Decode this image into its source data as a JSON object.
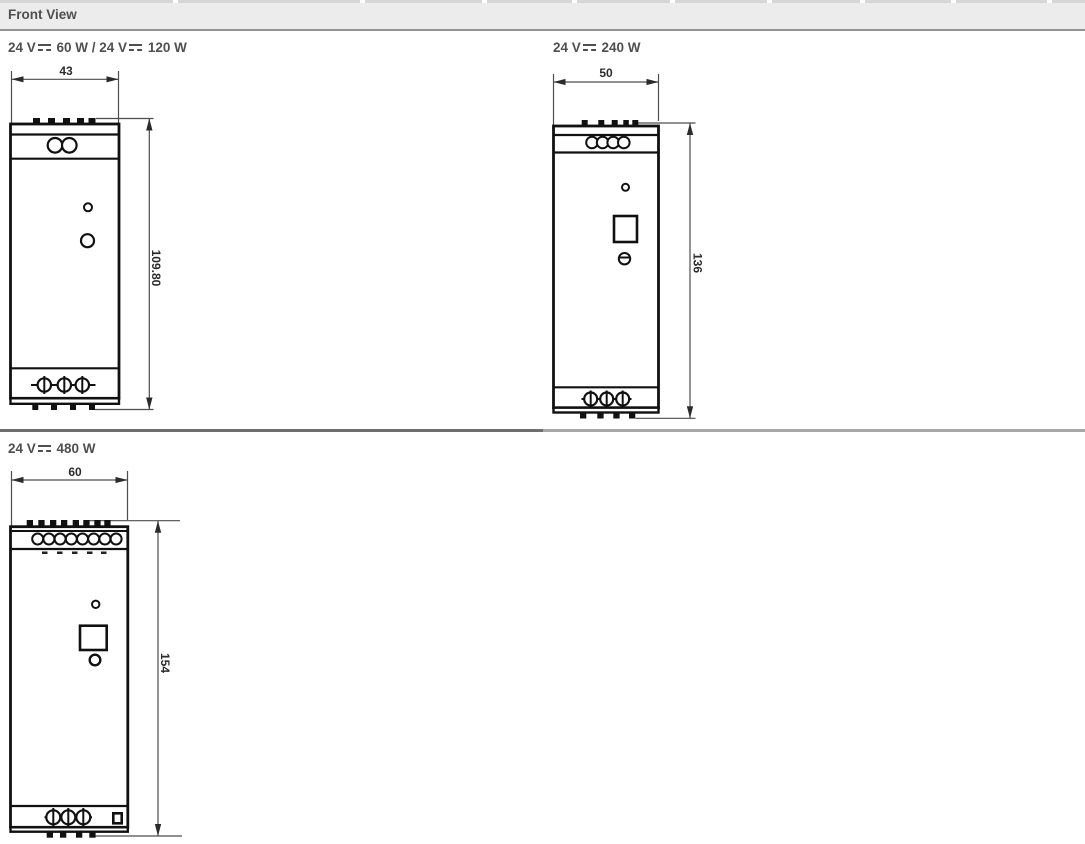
{
  "header": {
    "title": "Front View"
  },
  "sections": [
    {
      "title": "24 V⎓ 60 W / 24 V⎓ 120 W",
      "width_label": "43",
      "height_label": "109.80"
    },
    {
      "title": "24 V⎓ 240 W",
      "width_label": "50",
      "height_label": "136"
    },
    {
      "title": "24 V⎓ 480 W",
      "width_label": "60",
      "height_label": "154"
    }
  ],
  "icons": {
    "dc_symbol": "⎓ (solid line over dashed line, DC current)"
  },
  "colors": {
    "header_bg": "#ececec",
    "header_border": "#949494",
    "label_text": "#4f4f4f",
    "drawing_line": "#111111",
    "dimension_line": "#4d4d4d",
    "divider_left": "#6e6e6e",
    "divider_right": "#a8a8a8"
  }
}
